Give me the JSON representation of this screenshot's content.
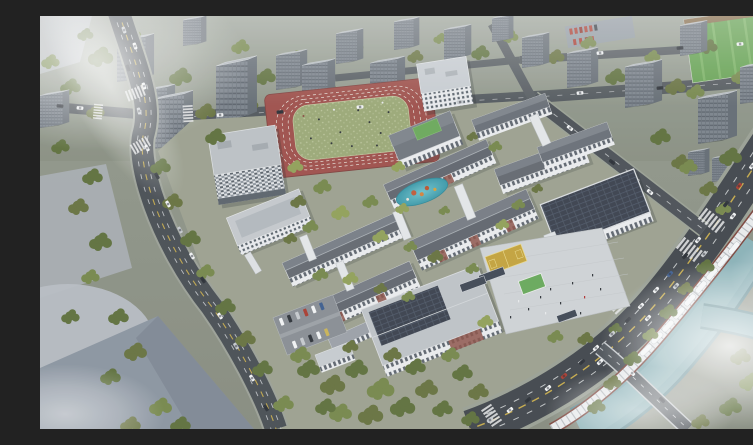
{
  "image": {
    "kind": "architectural aerial rendering",
    "subject": "Bird's-eye rendering of a school campus masterplan surrounded by residential towers, tree-lined roads, a river and an elevated rail line",
    "aria_label": "Aerial rendering of a school campus with running track, white classroom buildings, solar-roofed halls and entrance plaza, surrounded by gray residential towers, a busy boulevard, an elevated rail with a white train, and a misty teal river"
  },
  "palette": {
    "haze": "#ffffff",
    "asphalt_major": "#40454b",
    "asphalt_minor": "#51575c",
    "lane_yellow": "#d4b54a",
    "lane_white": "#dfe2e4",
    "tower_face": "#79828b",
    "tower_side": "#636b73",
    "tower_roof": "#b2b8be",
    "tree_dark": "#43512f",
    "tree_mid": "#5d6f3c",
    "tree_light": "#74864a",
    "campus_ground": "#9ba08f",
    "building_white": "#e9ebee",
    "roof_dark": "#5f656d",
    "roof_light": "#c3c8cd",
    "solar_roof": "#39404c",
    "brick_accent": "#8a5045",
    "track_red": "#9d4f4a",
    "field_green": "#9aa877",
    "pond_teal": "#3fa0af",
    "river": "#7fa9b0",
    "plaza": "#ced2d5",
    "viaduct_girder": "#7c443b",
    "viaduct_deck": "#e9ebed",
    "sports_field_bright": "#63a050",
    "car_red": "#a83c30",
    "flat_lot": "#8a94a0"
  },
  "scene": {
    "background": {
      "residential_towers": 22,
      "green_sports_field_top_right": true,
      "red_car_parking_lot_top_right": true,
      "tree_rows_between_towers": true
    },
    "campus": {
      "running_track": "red track with green speckled infield and tiny figures",
      "buildings": [
        "tall-white-dormitory-tower",
        "checker-facade-dormitory",
        "white-mid-block",
        "classroom-slab-1",
        "classroom-slab-2-with-brick-accents",
        "classroom-slab-3",
        "classroom-slab-4",
        "northeast-classroom-cluster",
        "solar-roof-gymnasium",
        "solar-roof-auditorium",
        "annex"
      ],
      "pond": "teal pond with orange playground equipment",
      "entrance_plaza": "light paved plaza with canopy, bike shelters and people",
      "basketball_courts": "yellow courts",
      "parking_lot": "two rows of parked cars"
    },
    "infrastructure": {
      "boulevard_with_traffic": true,
      "elevated_rail_with_white_train": true,
      "river_canal_with_branch": true,
      "road_bridge_over_river": true,
      "crosswalks": 7
    },
    "atmosphere": {
      "mist_regions": [
        "top-left",
        "bottom-right",
        "bottom-left",
        "right-middle"
      ],
      "lighting": "soft overcast daylight"
    }
  }
}
